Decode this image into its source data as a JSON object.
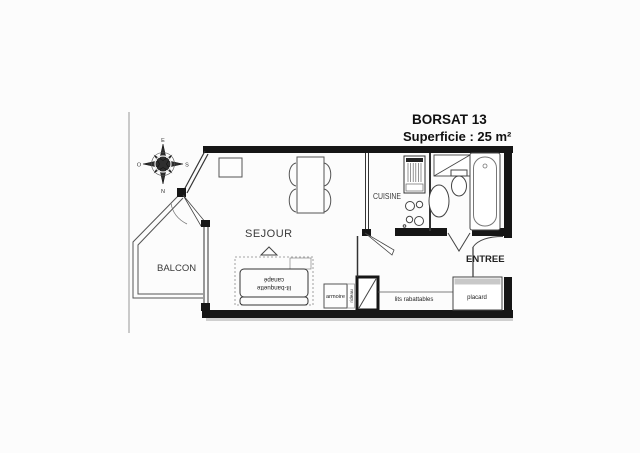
{
  "title": {
    "line1": "BORSAT 13",
    "line2": "Superficie : 25 m²"
  },
  "rooms": {
    "sejour": "SEJOUR",
    "balcon": "BALCON",
    "cuisine": "CUISINE",
    "entree": "ENTREE"
  },
  "furniture": {
    "armoire": "armoire",
    "rideau": "rideau",
    "lits_rabattables": "lits rabattables",
    "placard": "placard"
  },
  "sofa": {
    "line1": "canapé",
    "line2": "lit-banquette"
  },
  "compass": {
    "top": "E",
    "right": "S",
    "bottom": "N",
    "left": "O"
  },
  "colors": {
    "wall": "#161616",
    "thin_line": "#4a4a4a",
    "paper": "#fcfcfc",
    "shade_gray": "#c8c8c8"
  }
}
